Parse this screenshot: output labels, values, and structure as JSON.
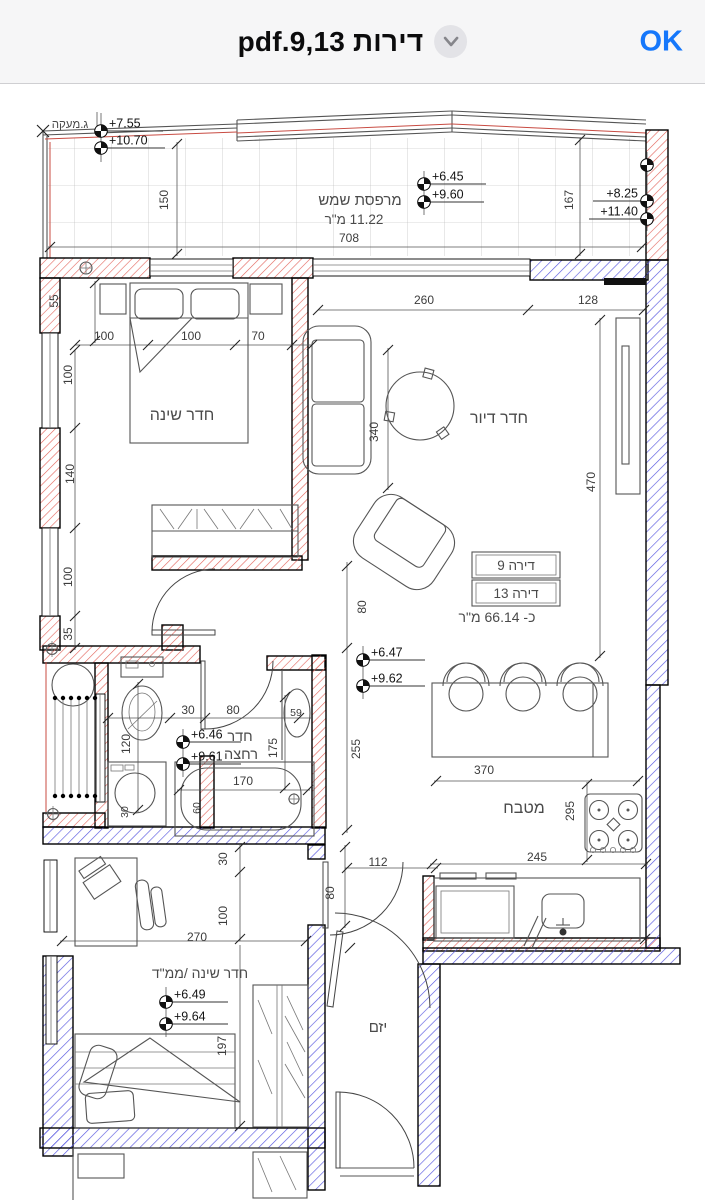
{
  "header": {
    "title": "דירות 9,13.pdf",
    "ok_label": "OK"
  },
  "viewer": {
    "apartment_table": {
      "apartments": [
        "דירה 9",
        "דירה 13"
      ],
      "area": "כ- 66.14 מ\"ר"
    },
    "colors": {
      "new_wall_hatch": "#d9534f",
      "existing_wall_hatch": "#5a5ae0",
      "railing_line": "#c84b42",
      "tile_line": "#b3b3b3",
      "ok_button": "#1577fb"
    },
    "labels": [
      {
        "t": "ג.מעקה",
        "x": 70,
        "y": 128,
        "s": 11.5,
        "kind": "room"
      },
      {
        "t": "150",
        "x": 168,
        "y": 200,
        "rot": -90
      },
      {
        "t": "מרפסת שמש",
        "x": 360,
        "y": 205,
        "s": 15,
        "kind": "room"
      },
      {
        "t": "11.22 מ\"ר",
        "x": 354,
        "y": 224,
        "s": 13.5,
        "kind": "room"
      },
      {
        "t": "708",
        "x": 349,
        "y": 242
      },
      {
        "t": "167",
        "x": 573,
        "y": 200,
        "rot": -90
      },
      {
        "t": "55",
        "x": 58,
        "y": 301,
        "rot": -90
      },
      {
        "t": "100",
        "x": 104,
        "y": 340
      },
      {
        "t": "100",
        "x": 191,
        "y": 340
      },
      {
        "t": "70",
        "x": 258,
        "y": 340
      },
      {
        "t": "100",
        "x": 72,
        "y": 375,
        "rot": -90
      },
      {
        "t": "140",
        "x": 74,
        "y": 474,
        "rot": -90
      },
      {
        "t": "100",
        "x": 72,
        "y": 577,
        "rot": -90
      },
      {
        "t": "35",
        "x": 72,
        "y": 634,
        "rot": -90
      },
      {
        "t": "חדר שינה",
        "x": 182,
        "y": 420,
        "s": 16,
        "kind": "room"
      },
      {
        "t": "260",
        "x": 424,
        "y": 304
      },
      {
        "t": "128",
        "x": 588,
        "y": 304
      },
      {
        "t": "340",
        "x": 378,
        "y": 432,
        "rot": -90
      },
      {
        "t": "470",
        "x": 595,
        "y": 482,
        "rot": -90
      },
      {
        "t": "חדר דיור",
        "x": 499,
        "y": 423,
        "s": 16,
        "kind": "room"
      },
      {
        "t": "דירה 9",
        "x": 516,
        "y": 570,
        "s": 13.5,
        "kind": "room"
      },
      {
        "t": "דירה 13",
        "x": 516,
        "y": 598,
        "s": 13.5,
        "kind": "room"
      },
      {
        "t": "כ- 66.14 מ\"ר",
        "x": 497,
        "y": 622,
        "s": 14,
        "kind": "room"
      },
      {
        "t": "80",
        "x": 366,
        "y": 607,
        "rot": -90
      },
      {
        "t": "255",
        "x": 360,
        "y": 749,
        "rot": -90
      },
      {
        "t": "370",
        "x": 484,
        "y": 774
      },
      {
        "t": "מטבח",
        "x": 524,
        "y": 813,
        "s": 16,
        "kind": "room"
      },
      {
        "t": "295",
        "x": 574,
        "y": 811,
        "rot": -90
      },
      {
        "t": "245",
        "x": 537,
        "y": 861
      },
      {
        "t": "30",
        "x": 188,
        "y": 714
      },
      {
        "t": "80",
        "x": 233,
        "y": 714
      },
      {
        "t": "59",
        "x": 296,
        "y": 716,
        "s": 10.5
      },
      {
        "t": "חדר",
        "x": 240,
        "y": 741,
        "s": 14.5,
        "kind": "room"
      },
      {
        "t": "רחצה",
        "x": 241,
        "y": 759,
        "s": 14.5,
        "kind": "room"
      },
      {
        "t": "120",
        "x": 130,
        "y": 744,
        "rot": -90
      },
      {
        "t": "175",
        "x": 277,
        "y": 748,
        "rot": -90
      },
      {
        "t": "170",
        "x": 243,
        "y": 785
      },
      {
        "t": "60",
        "x": 200,
        "y": 808,
        "rot": -90,
        "s": 10.5
      },
      {
        "t": "30",
        "x": 128,
        "y": 812,
        "rot": -90,
        "s": 10.5
      },
      {
        "t": "30",
        "x": 227,
        "y": 859,
        "rot": -90
      },
      {
        "t": "100",
        "x": 227,
        "y": 916,
        "rot": -90
      },
      {
        "t": "270",
        "x": 197,
        "y": 941
      },
      {
        "t": "80",
        "x": 334,
        "y": 893,
        "rot": -90
      },
      {
        "t": "112",
        "x": 378,
        "y": 866
      },
      {
        "t": "חדר שינה /ממ\"ד",
        "x": 200,
        "y": 978,
        "s": 14,
        "kind": "room"
      },
      {
        "t": "197",
        "x": 226,
        "y": 1046,
        "rot": -90
      },
      {
        "t": "יזם",
        "x": 378,
        "y": 1032,
        "s": 15,
        "kind": "room"
      }
    ],
    "levels": [
      {
        "t": "+7.55",
        "cx": 101,
        "cy": 131,
        "len": 62
      },
      {
        "t": "+10.70",
        "cx": 101,
        "cy": 148,
        "len": 64
      },
      {
        "t": "+6.45",
        "cx": 424,
        "cy": 184,
        "len": 62
      },
      {
        "t": "+9.60",
        "cx": 424,
        "cy": 202,
        "len": 60
      },
      {
        "t": "",
        "cx": 647,
        "cy": 165,
        "len": 0
      },
      {
        "t": "+8.25",
        "cx": 647,
        "cy": 201,
        "len": -54
      },
      {
        "t": "+11.40",
        "cx": 647,
        "cy": 219,
        "len": -58
      },
      {
        "t": "+6.47",
        "cx": 363,
        "cy": 660,
        "len": 62
      },
      {
        "t": "+9.62",
        "cx": 363,
        "cy": 686,
        "len": 62
      },
      {
        "t": "+6.46",
        "cx": 183,
        "cy": 742,
        "len": 58
      },
      {
        "t": "+9.61",
        "cx": 183,
        "cy": 764,
        "len": 58
      },
      {
        "t": "+6.49",
        "cx": 166,
        "cy": 1002,
        "len": 62
      },
      {
        "t": "+9.64",
        "cx": 166,
        "cy": 1024,
        "len": 62
      }
    ]
  }
}
